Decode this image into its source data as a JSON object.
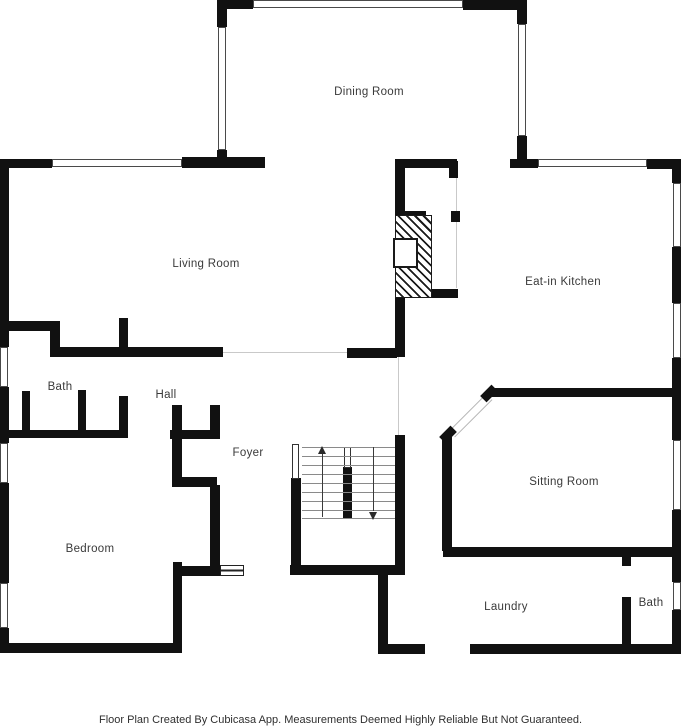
{
  "footer": {
    "text": "Floor Plan Created By Cubicasa App. Measurements Deemed Highly Reliable But Not Guaranteed."
  },
  "colors": {
    "wall": "#111111",
    "open_line": "#c9c9c9",
    "tread": "#8a8a8a",
    "label_text": "#3a3a3a",
    "background": "#ffffff"
  },
  "plan": {
    "labels": [
      {
        "text": "Dining Room",
        "x": 369,
        "y": 92
      },
      {
        "text": "Living Room",
        "x": 206,
        "y": 264
      },
      {
        "text": "Eat-in Kitchen",
        "x": 563,
        "y": 282
      },
      {
        "text": "Bath",
        "x": 60,
        "y": 387
      },
      {
        "text": "Hall",
        "x": 166,
        "y": 395
      },
      {
        "text": "Foyer",
        "x": 248,
        "y": 453
      },
      {
        "text": "Sitting Room",
        "x": 564,
        "y": 482
      },
      {
        "text": "Bedroom",
        "x": 90,
        "y": 549
      },
      {
        "text": "Laundry",
        "x": 506,
        "y": 607
      },
      {
        "text": "Bath",
        "x": 651,
        "y": 603
      }
    ],
    "walls": [
      [
        217,
        0,
        36,
        9
      ],
      [
        463,
        0,
        62,
        10
      ],
      [
        217,
        0,
        10,
        27
      ],
      [
        217,
        150,
        10,
        18
      ],
      [
        517,
        0,
        10,
        24
      ],
      [
        517,
        136,
        10,
        31
      ],
      [
        0,
        159,
        52,
        9
      ],
      [
        182,
        157,
        83,
        11
      ],
      [
        510,
        159,
        28,
        9
      ],
      [
        647,
        159,
        34,
        10
      ],
      [
        0,
        159,
        9,
        188
      ],
      [
        0,
        387,
        9,
        56
      ],
      [
        0,
        483,
        9,
        100
      ],
      [
        0,
        628,
        9,
        25
      ],
      [
        672,
        159,
        9,
        24
      ],
      [
        672,
        247,
        9,
        56
      ],
      [
        672,
        358,
        9,
        82
      ],
      [
        672,
        510,
        9,
        47
      ],
      [
        672,
        557,
        9,
        25
      ],
      [
        672,
        610,
        9,
        43
      ],
      [
        0,
        643,
        182,
        10
      ],
      [
        378,
        644,
        47,
        10
      ],
      [
        470,
        644,
        211,
        10
      ],
      [
        492,
        388,
        189,
        9
      ],
      [
        443,
        547,
        238,
        10
      ],
      [
        442,
        437,
        10,
        114
      ],
      [
        378,
        573,
        10,
        77
      ],
      [
        622,
        556,
        9,
        10
      ],
      [
        622,
        597,
        9,
        50
      ],
      [
        9,
        321,
        51,
        10
      ],
      [
        50,
        331,
        10,
        26
      ],
      [
        50,
        347,
        173,
        10
      ],
      [
        119,
        318,
        9,
        39
      ],
      [
        347,
        348,
        50,
        10
      ],
      [
        22,
        391,
        8,
        46
      ],
      [
        78,
        390,
        8,
        47
      ],
      [
        119,
        396,
        9,
        41
      ],
      [
        3,
        430,
        125,
        8
      ],
      [
        395,
        159,
        10,
        56
      ],
      [
        395,
        159,
        62,
        9
      ],
      [
        449,
        161,
        9,
        17
      ],
      [
        395,
        211,
        31,
        9
      ],
      [
        451,
        211,
        9,
        11
      ],
      [
        425,
        215,
        7,
        83
      ],
      [
        395,
        289,
        63,
        9
      ],
      [
        395,
        298,
        10,
        59
      ],
      [
        395,
        435,
        10,
        140
      ],
      [
        172,
        405,
        10,
        82
      ],
      [
        210,
        405,
        10,
        30
      ],
      [
        170,
        430,
        50,
        9
      ],
      [
        172,
        477,
        45,
        10
      ],
      [
        210,
        485,
        10,
        90
      ],
      [
        173,
        562,
        9,
        91
      ],
      [
        180,
        566,
        42,
        10
      ],
      [
        290,
        565,
        115,
        10
      ],
      [
        291,
        478,
        10,
        97
      ],
      [
        343,
        467,
        9,
        51
      ]
    ],
    "windows": [
      [
        253,
        0,
        210,
        8
      ],
      [
        218,
        27,
        8,
        123
      ],
      [
        518,
        24,
        8,
        112
      ],
      [
        52,
        159,
        130,
        8
      ],
      [
        538,
        159,
        109,
        8
      ],
      [
        673,
        183,
        8,
        64
      ],
      [
        673,
        303,
        8,
        55
      ],
      [
        673,
        440,
        8,
        70
      ],
      [
        673,
        582,
        8,
        28
      ],
      [
        0,
        347,
        8,
        40
      ],
      [
        0,
        443,
        8,
        40
      ],
      [
        0,
        583,
        8,
        45
      ]
    ],
    "open_lines": [
      [
        456,
        178,
        1,
        33
      ],
      [
        456,
        222,
        1,
        66
      ],
      [
        398,
        357,
        1,
        78
      ],
      [
        223,
        352,
        124,
        1
      ]
    ],
    "railings": [
      [
        292,
        444,
        7,
        35
      ],
      [
        344,
        447,
        7,
        21
      ]
    ],
    "treads": {
      "x": 302,
      "w": 93,
      "ys": [
        447,
        456,
        465,
        474,
        483,
        492,
        501,
        510,
        518
      ]
    },
    "arrows": [
      {
        "dir": "up",
        "shaft": [
          322,
          453,
          64
        ],
        "head_x": 322,
        "head_y": 446
      },
      {
        "dir": "down",
        "shaft": [
          373,
          447,
          64
        ],
        "head_x": 373,
        "head_y": 512
      }
    ],
    "fireplace": {
      "hatch": [
        395,
        215,
        37,
        83
      ],
      "firebox": [
        393,
        238,
        25,
        30
      ]
    },
    "angled_opening": {
      "strip": [
        444,
        411,
        53,
        9,
        -45
      ],
      "tips": [
        [
          440,
          430,
          16,
          9,
          -45
        ],
        [
          481,
          389,
          16,
          9,
          -45
        ]
      ]
    },
    "thresholds": [
      [
        220,
        565,
        24,
        11
      ]
    ]
  }
}
